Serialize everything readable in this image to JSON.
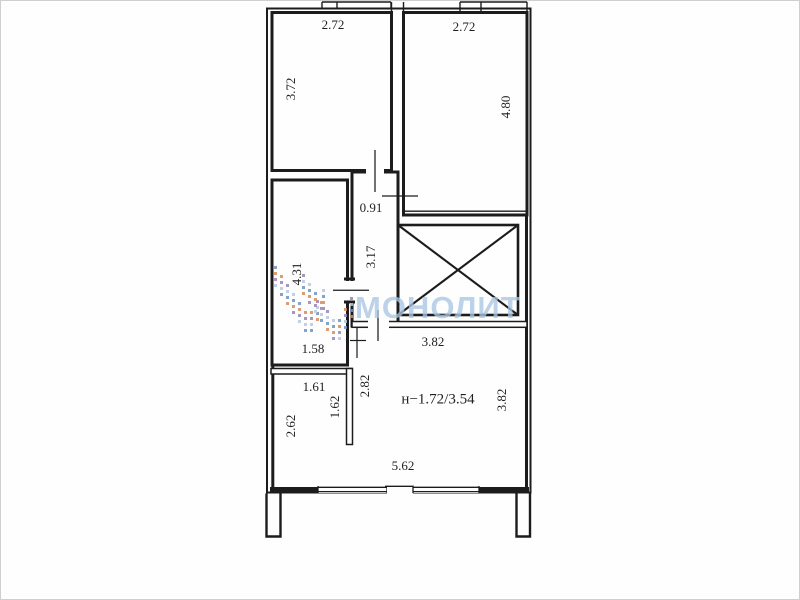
{
  "title": "apartment-floor-plan",
  "watermark": {
    "text": "МОНОЛИТ",
    "text_color": "#a9c6e4",
    "logo_palette": [
      "#6f92c1",
      "#d98a5c",
      "#9b83b8",
      "#b7c9e2"
    ]
  },
  "colors": {
    "wall": "#1c1c1c",
    "background": "#fefefe",
    "dimension_text": "#1f1f1f"
  },
  "plan": {
    "room_area_label": "н−1.72/3.54",
    "dimensions": [
      {
        "text": "2.72",
        "x": 333,
        "y": 26,
        "rot": 0,
        "size": 13
      },
      {
        "text": "3.72",
        "x": 292,
        "y": 89,
        "rot": -90,
        "size": 13
      },
      {
        "text": "2.72",
        "x": 464,
        "y": 28,
        "rot": 0,
        "size": 13
      },
      {
        "text": "4.80",
        "x": 507,
        "y": 107,
        "rot": -90,
        "size": 13
      },
      {
        "text": "0.91",
        "x": 371,
        "y": 209,
        "rot": 0,
        "size": 13
      },
      {
        "text": "3.17",
        "x": 372,
        "y": 257,
        "rot": -90,
        "size": 13
      },
      {
        "text": "4.31",
        "x": 298,
        "y": 274,
        "rot": -90,
        "size": 13
      },
      {
        "text": "1.58",
        "x": 313,
        "y": 350,
        "rot": 0,
        "size": 13
      },
      {
        "text": "1.61",
        "x": 314,
        "y": 388,
        "rot": 0,
        "size": 13
      },
      {
        "text": "1.62",
        "x": 336,
        "y": 407,
        "rot": -90,
        "size": 13
      },
      {
        "text": "2.62",
        "x": 292,
        "y": 426,
        "rot": -90,
        "size": 13
      },
      {
        "text": "2.82",
        "x": 366,
        "y": 386,
        "rot": -90,
        "size": 13
      },
      {
        "text": "3.82",
        "x": 433,
        "y": 343,
        "rot": 0,
        "size": 13
      },
      {
        "text": "3.82",
        "x": 503,
        "y": 400,
        "rot": -90,
        "size": 13
      },
      {
        "text": "н−1.72/3.54",
        "x": 438,
        "y": 400,
        "rot": 0,
        "size": 15
      },
      {
        "text": "5.62",
        "x": 403,
        "y": 467,
        "rot": 0,
        "size": 13
      }
    ]
  }
}
